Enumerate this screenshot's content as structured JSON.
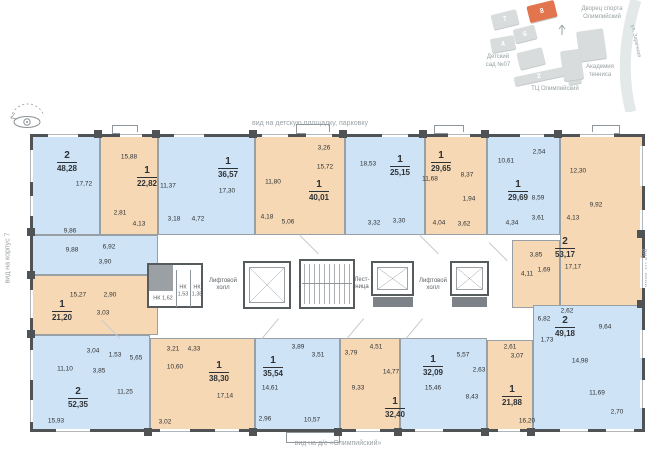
{
  "legend": {
    "view_top": "вид на детскую площадку, парковку",
    "view_bottom": "вид на д/с «Олимпийский»",
    "view_left": "вид на корпус 7",
    "view_right": "вид на двор"
  },
  "site_map": {
    "labels": {
      "sports_palace": "Дворец спорта\nОлимпийский",
      "kindergarten": "Детский\nсад №07",
      "mall": "ТЦ Олимпийский",
      "tennis_academy": "Академия\nтенниса",
      "street": "ул. Заречная"
    },
    "buildings": [
      {
        "number": "7"
      },
      {
        "number": "8"
      },
      {
        "number": "6"
      },
      {
        "number": "4"
      },
      {
        "number": "2"
      }
    ],
    "colors": {
      "building": "#d8dcdc",
      "highlight": "#e2754e"
    }
  },
  "core": {
    "lift_hall_left": "Лифтовой\nхолл",
    "lift_hall_right": "Лифтовой\nхолл",
    "stairs": "Лест-\nница",
    "storage_1": "НК 1,62",
    "storage_2": "НК\n1,53",
    "storage_3": "НК\n1,38"
  },
  "apartments": [
    {
      "rooms": "2",
      "area": "48,28",
      "color": "blue",
      "room_areas": [
        "17,72",
        "9,86",
        "9,88",
        "6,92",
        "3,90"
      ]
    },
    {
      "rooms": "1",
      "area": "22,82",
      "color": "orange",
      "room_areas": [
        "15,88",
        "2,81",
        "4,13"
      ]
    },
    {
      "rooms": "1",
      "area": "36,57",
      "color": "blue",
      "room_areas": [
        "11,37",
        "17,30",
        "3,18",
        "4,72"
      ]
    },
    {
      "rooms": "1",
      "area": "40,01",
      "color": "orange",
      "room_areas": [
        "3,26",
        "15,72",
        "11,80",
        "4,18",
        "5,06"
      ]
    },
    {
      "rooms": "1",
      "area": "25,15",
      "color": "blue",
      "room_areas": [
        "18,53",
        "3,30",
        "3,32"
      ]
    },
    {
      "rooms": "1",
      "area": "29,65",
      "color": "orange",
      "room_areas": [
        "11,68",
        "8,37",
        "1,94",
        "4,04",
        "3,62"
      ]
    },
    {
      "rooms": "1",
      "area": "29,69",
      "color": "blue",
      "room_areas": [
        "10,61",
        "2,54",
        "8,59",
        "3,61",
        "4,34"
      ]
    },
    {
      "rooms": "2",
      "area": "53,17",
      "color": "orange",
      "room_areas": [
        "12,30",
        "9,92",
        "4,13",
        "17,17",
        "3,85",
        "1,69",
        "4,11"
      ]
    },
    {
      "rooms": "2",
      "area": "49,18",
      "color": "blue",
      "room_areas": [
        "2,62",
        "6,82",
        "9,64",
        "1,73",
        "14,98",
        "11,69",
        "2,70"
      ]
    },
    {
      "rooms": "1",
      "area": "21,88",
      "color": "orange",
      "room_areas": [
        "2,61",
        "3,07",
        "16,20"
      ]
    },
    {
      "rooms": "1",
      "area": "32,09",
      "color": "blue",
      "room_areas": [
        "5,57",
        "2,63",
        "15,46",
        "8,43"
      ]
    },
    {
      "rooms": "1",
      "area": "32,40",
      "color": "orange",
      "room_areas": [
        "4,51",
        "3,79",
        "14,77",
        "9,33"
      ]
    },
    {
      "rooms": "1",
      "area": "35,54",
      "color": "blue",
      "room_areas": [
        "3,89",
        "3,51",
        "14,61",
        "2,96",
        "10,57"
      ]
    },
    {
      "rooms": "1",
      "area": "38,30",
      "color": "orange",
      "room_areas": [
        "3,21",
        "4,33",
        "10,60",
        "17,14",
        "3,02"
      ]
    },
    {
      "rooms": "2",
      "area": "52,35",
      "color": "blue",
      "room_areas": [
        "3,04",
        "1,53",
        "5,65",
        "11,10",
        "3,85",
        "11,25",
        "15,93"
      ]
    },
    {
      "rooms": "1",
      "area": "21,20",
      "color": "orange",
      "room_areas": [
        "15,27",
        "2,90",
        "3,03"
      ]
    }
  ],
  "colors": {
    "apartment_blue": "#cee3f6",
    "apartment_orange": "#f7d8b4",
    "walls": "#4f5355"
  }
}
